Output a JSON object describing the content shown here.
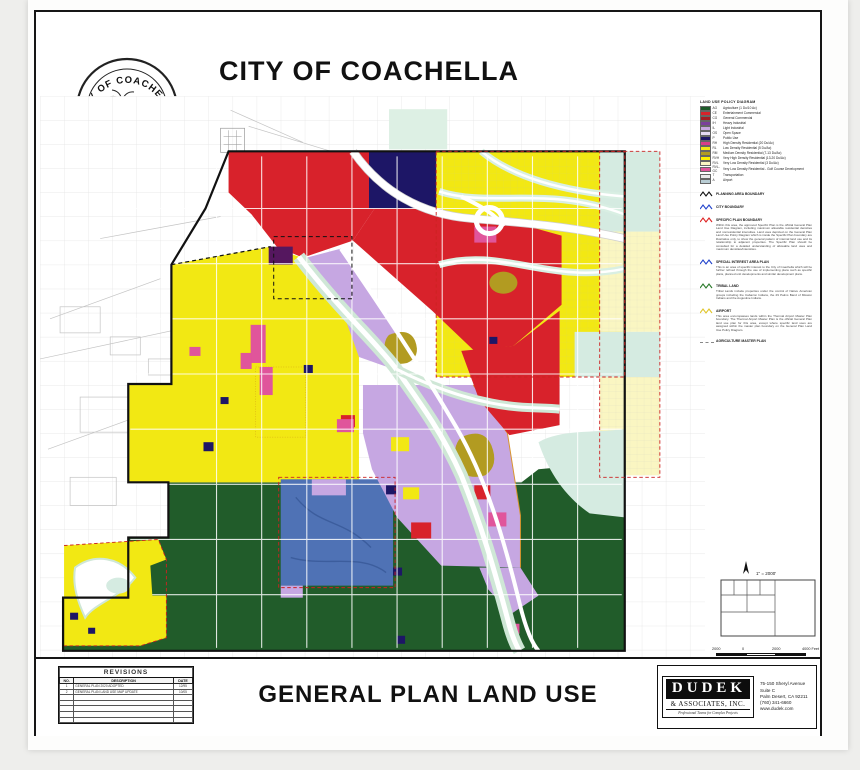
{
  "header": {
    "title": "CITY OF COACHELLA",
    "seal_top": "CITY OF COACHELLA",
    "seal_bottom": "CALIFORNIA"
  },
  "legend": {
    "title": "LAND USE POLICY DIAGRAM",
    "items": [
      {
        "code": "AG",
        "label": "Agriculture (1 Du/10 Ac)",
        "color": "#1e5b2a"
      },
      {
        "code": "CE",
        "label": "Entertainment Commercial",
        "color": "#d8222b"
      },
      {
        "code": "CG",
        "label": "General Commercial",
        "color": "#a41d24"
      },
      {
        "code": "IH",
        "label": "Heavy Industrial",
        "color": "#7a3f9d"
      },
      {
        "code": "IL",
        "label": "Light Industrial",
        "color": "#c6a7e2"
      },
      {
        "code": "OS",
        "label": "Open Space",
        "color": "#e4d9f2"
      },
      {
        "code": "P",
        "label": "Public Use",
        "color": "#1d1666"
      },
      {
        "code": "RH",
        "label": "High Density Residential (20 Du/Ac)",
        "color": "#d93d87"
      },
      {
        "code": "RL",
        "label": "Low Density Residential (5 Du/Ac)",
        "color": "#f2e813"
      },
      {
        "code": "RM",
        "label": "Medium Density Residential (7-13 Du/Ac)",
        "color": "#b29b21"
      },
      {
        "code": "RVH",
        "label": "Very High Density Residential (13-20 Du/Ac)",
        "color": "#fff100"
      },
      {
        "code": "RVL",
        "label": "Very Low Density Residential (3 Du/Ac)",
        "color": "#faf6c2"
      },
      {
        "code": "RVL-GC",
        "label": "Very Low Density Residential - Golf Course Development",
        "color": "#e0559b"
      },
      {
        "code": "T",
        "label": "Transportation",
        "color": "#e9e9e9"
      },
      {
        "code": "A",
        "label": "Airport",
        "color": "#b9cdd4"
      }
    ],
    "boundaries": [
      {
        "label": "PLANNING AREA BOUNDARY",
        "style": "zigzag",
        "color": "#111111",
        "note": ""
      },
      {
        "label": "CITY BOUNDARY",
        "style": "zigzag",
        "color": "#2244cc",
        "note": ""
      },
      {
        "label": "SPECIFIC PLAN BOUNDARY",
        "style": "zigzag",
        "color": "#dd2222",
        "note": "Within this area, the approved Specific Plan is the official General Plan Land Use Diagram, including maximum allowable residential densities and nonresidential intensities. Land uses depicted on the General Plan Land Use Policy Diagram which is inside the Specific Plan boundary are illustrative only, to show the general pattern of internal land use and its relationship to adjacent properties. The Specific Plan should be consulted for a detailed understanding of allowable land uses and maximum densities/intensities."
      },
      {
        "label": "SPECIAL INTEREST AREA PLAN",
        "style": "zigzag",
        "color": "#2244cc",
        "note": "This is an area of specific interest to the City of Coachella which will be further refined through the use of implementing plans such as specific plans, planned unit developments and similar development plans."
      },
      {
        "label": "TRIBAL LAND",
        "style": "zigzag",
        "color": "#2a7a2a",
        "note": "Tribal Lands include properties under the control of Native American groups including the Cabazon Indians, the 29 Palms Band of Mission Indians and the Augustine Indians."
      },
      {
        "label": "AIRPORT",
        "style": "zigzag",
        "color": "#e0c52a",
        "note": "This area encompasses lands within the Thermal Airport Master Plan boundary. The Thermal Airport Master Plan is the official General Plan land use plan for this area, except where specific land uses are assigned within the master plan boundary on the General Plan Land Use Policy Diagram."
      },
      {
        "label": "AGRICULTURE MASTER PLAN",
        "style": "dash",
        "color": "#888888",
        "note": ""
      }
    ]
  },
  "scale_block": {
    "north_scale": "1\" = 2000'",
    "bar_labels": [
      "2000",
      "0",
      "2000",
      "4000 Feet"
    ],
    "date": "OCTOBER 2005"
  },
  "footer": {
    "revisions": {
      "title": "REVISIONS",
      "columns": [
        "NO.",
        "DESCRIPTION",
        "DATE"
      ],
      "rows": [
        [
          "1",
          "GENERAL PLAN 2020 ADOPTED",
          "12/95"
        ],
        [
          "2",
          "GENERAL PLAN LAND USE MAP UPDATE",
          "10/05"
        ],
        [
          "",
          "",
          ""
        ],
        [
          "",
          "",
          ""
        ],
        [
          "",
          "",
          ""
        ],
        [
          "",
          "",
          ""
        ],
        [
          "",
          "",
          ""
        ]
      ]
    },
    "main_title": "GENERAL PLAN LAND USE",
    "firm": {
      "name": "DUDEK",
      "name2": "& ASSOCIATES, INC.",
      "tagline": "Professional Teams for Complex Projects",
      "address": [
        "75-150 Sheryl Avenue",
        "Suite C",
        "Palm Desert, CA 92211",
        "(760) 341-6660",
        "www.dudek.com"
      ]
    }
  },
  "map": {
    "colors": {
      "agriculture_green": "#215c2a",
      "commercial_red": "#d8222b",
      "residential_yellow": "#f2e813",
      "very_low_cream": "#faf6c2",
      "industrial_lavender": "#c6a7e2",
      "heavy_purple": "#55175f",
      "public_navy": "#1d1666",
      "golf_blue": "#4f72b5",
      "airport_teal": "#d5ebe1",
      "high_density_pink": "#e0559b",
      "medium_density_olive": "#b29b21",
      "wash_green": "#cfe7d6"
    }
  }
}
